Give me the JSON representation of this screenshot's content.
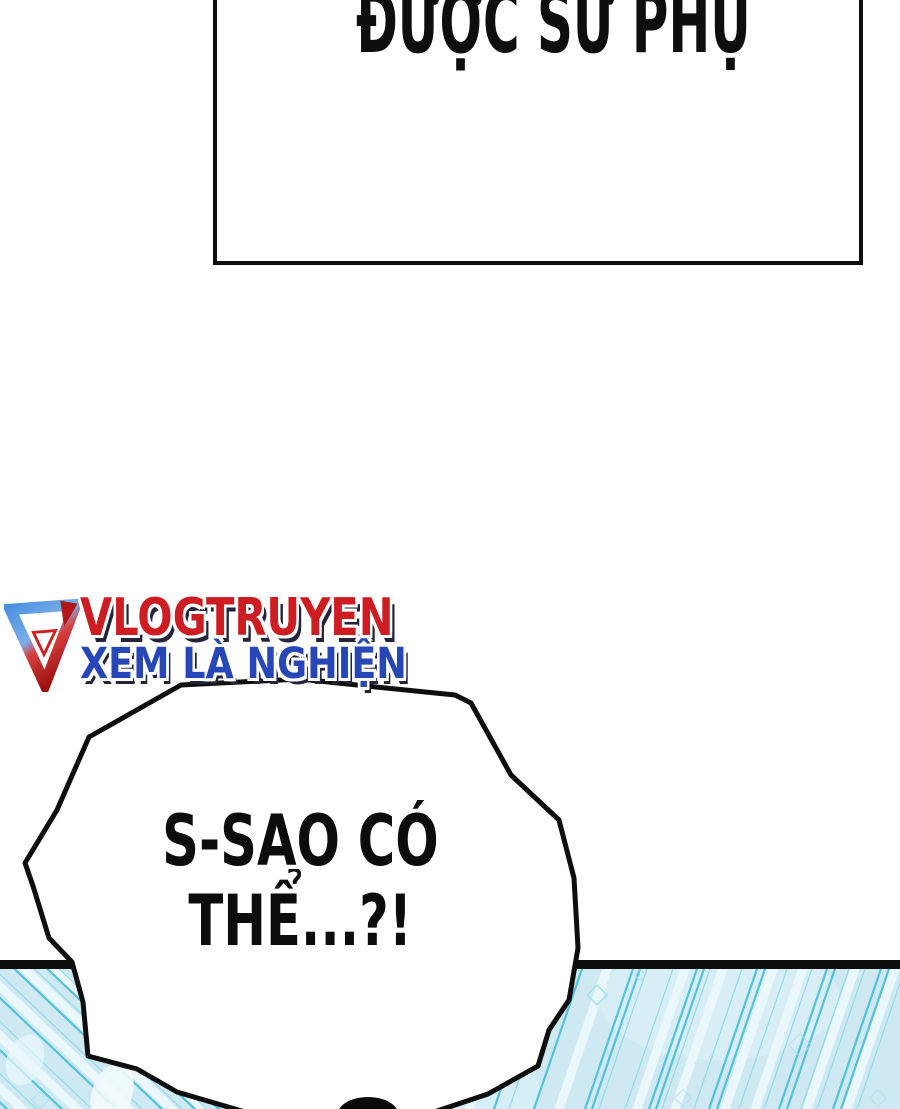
{
  "page": {
    "width": 900,
    "height": 1109
  },
  "top_panel": {
    "dialogue": "ĐƯỢC SƯ PHỤ"
  },
  "watermark": {
    "site_name": "VLOGTRUYEN",
    "tagline": "XEM LÀ NGHIỆN"
  },
  "bubble": {
    "line1": "S-SAO CÓ",
    "line2": "THỂ...?!"
  },
  "colors": {
    "ink": "#0e0e0e",
    "logo_red": "#ce1c23",
    "logo_blue": "#2746b8",
    "logo_shadow": "#23233a",
    "panel_blue": "#cfe9f3",
    "stripe_teal": "#54c2d9"
  }
}
